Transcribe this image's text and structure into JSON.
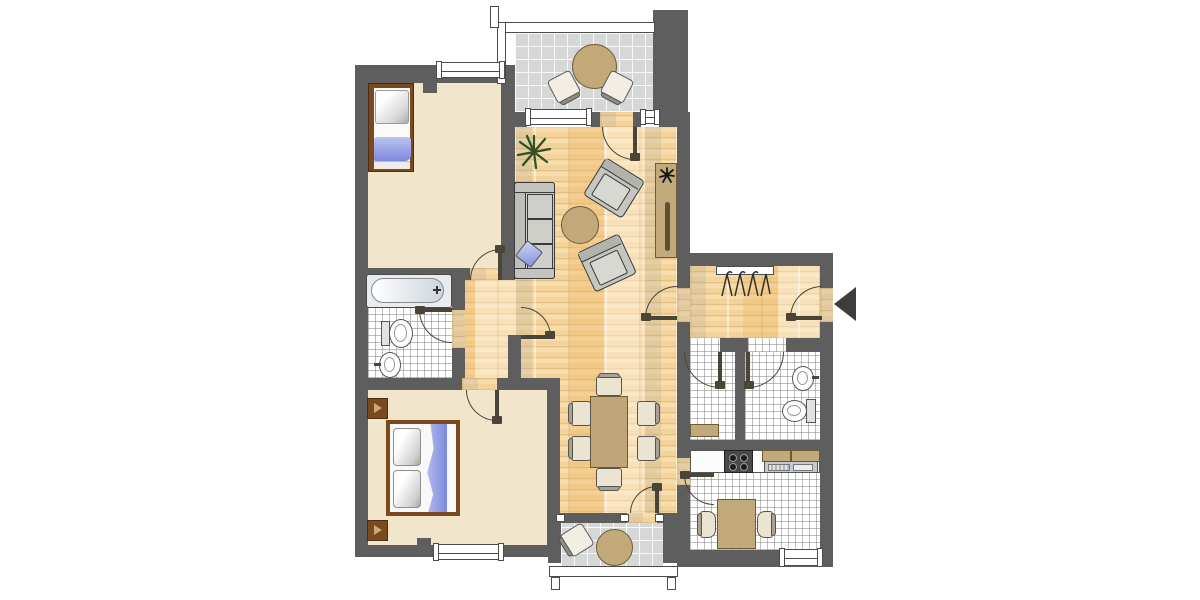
{
  "title": "apartment-floor-plan",
  "colors": {
    "wall": "#5e5e5e",
    "wood_base": "#f4d39a",
    "beige": "#f1e5cb",
    "balcony_floor": "#d6d8d7",
    "tan": "#c2a97a",
    "tan_dark": "#6d5c38",
    "bed_frame": "#7a4a1e",
    "blue": "#7d88dd",
    "blue_light": "#bcc3ef",
    "sofa_gray": "#cfcfca",
    "outline": "#3a3a3a",
    "door": "#4a4538",
    "plant_green": "#2b5426",
    "stove_dark": "#494949",
    "metal": "#c3c9cf"
  },
  "rooms": [
    {
      "id": "bedroom-1",
      "floor": "beige",
      "furniture": [
        "single-bed"
      ]
    },
    {
      "id": "living-room",
      "floor": "parquet",
      "furniture": [
        "sofa-3-seat",
        "blue-cushion",
        "round-coffee-table",
        "armchair",
        "armchair",
        "sideboard",
        "floor-plant",
        "sideboard-plant"
      ]
    },
    {
      "id": "dining-area",
      "floor": "parquet",
      "furniture": [
        "dining-table",
        "chair",
        "chair",
        "chair",
        "chair",
        "chair",
        "chair"
      ]
    },
    {
      "id": "entrance-hall",
      "floor": "parquet",
      "furniture": [
        "coat-rack"
      ]
    },
    {
      "id": "corridor",
      "floor": "parquet",
      "furniture": []
    },
    {
      "id": "bathroom",
      "floor": "white-tile",
      "furniture": [
        "bathtub",
        "toilet",
        "washbasin"
      ]
    },
    {
      "id": "storage-room",
      "floor": "white-tile",
      "furniture": [
        "shelf"
      ]
    },
    {
      "id": "wc",
      "floor": "white-tile",
      "furniture": [
        "washbasin",
        "toilet"
      ]
    },
    {
      "id": "kitchen",
      "floor": "white-tile",
      "furniture": [
        "counter",
        "stove-4-burners",
        "double-sink",
        "upper-cabinets",
        "kitchen-table",
        "chair",
        "chair"
      ]
    },
    {
      "id": "bedroom-2",
      "floor": "beige",
      "furniture": [
        "double-bed",
        "bedside-cabinet",
        "bedside-cabinet"
      ]
    },
    {
      "id": "balcony-top",
      "floor": "gray-tile",
      "railing": true,
      "furniture": [
        "round-table",
        "chair",
        "chair"
      ]
    },
    {
      "id": "balcony-bottom",
      "floor": "gray-tile",
      "railing": true,
      "furniture": [
        "round-table",
        "chair"
      ]
    }
  ],
  "windows": [
    "bedroom-1-top",
    "living-room-top-left",
    "living-room-top-right",
    "bedroom-2-bottom",
    "kitchen-bottom"
  ],
  "doors": [
    "bedroom-1",
    "bedroom-2",
    "bathroom",
    "corridor-junction",
    "balcony-top",
    "living-to-hall",
    "entrance",
    "storage",
    "wc",
    "kitchen",
    "balcony-bottom"
  ],
  "entrance": {
    "marker": "black-arrow",
    "direction": "left",
    "location": "right-wall-of-hall"
  }
}
